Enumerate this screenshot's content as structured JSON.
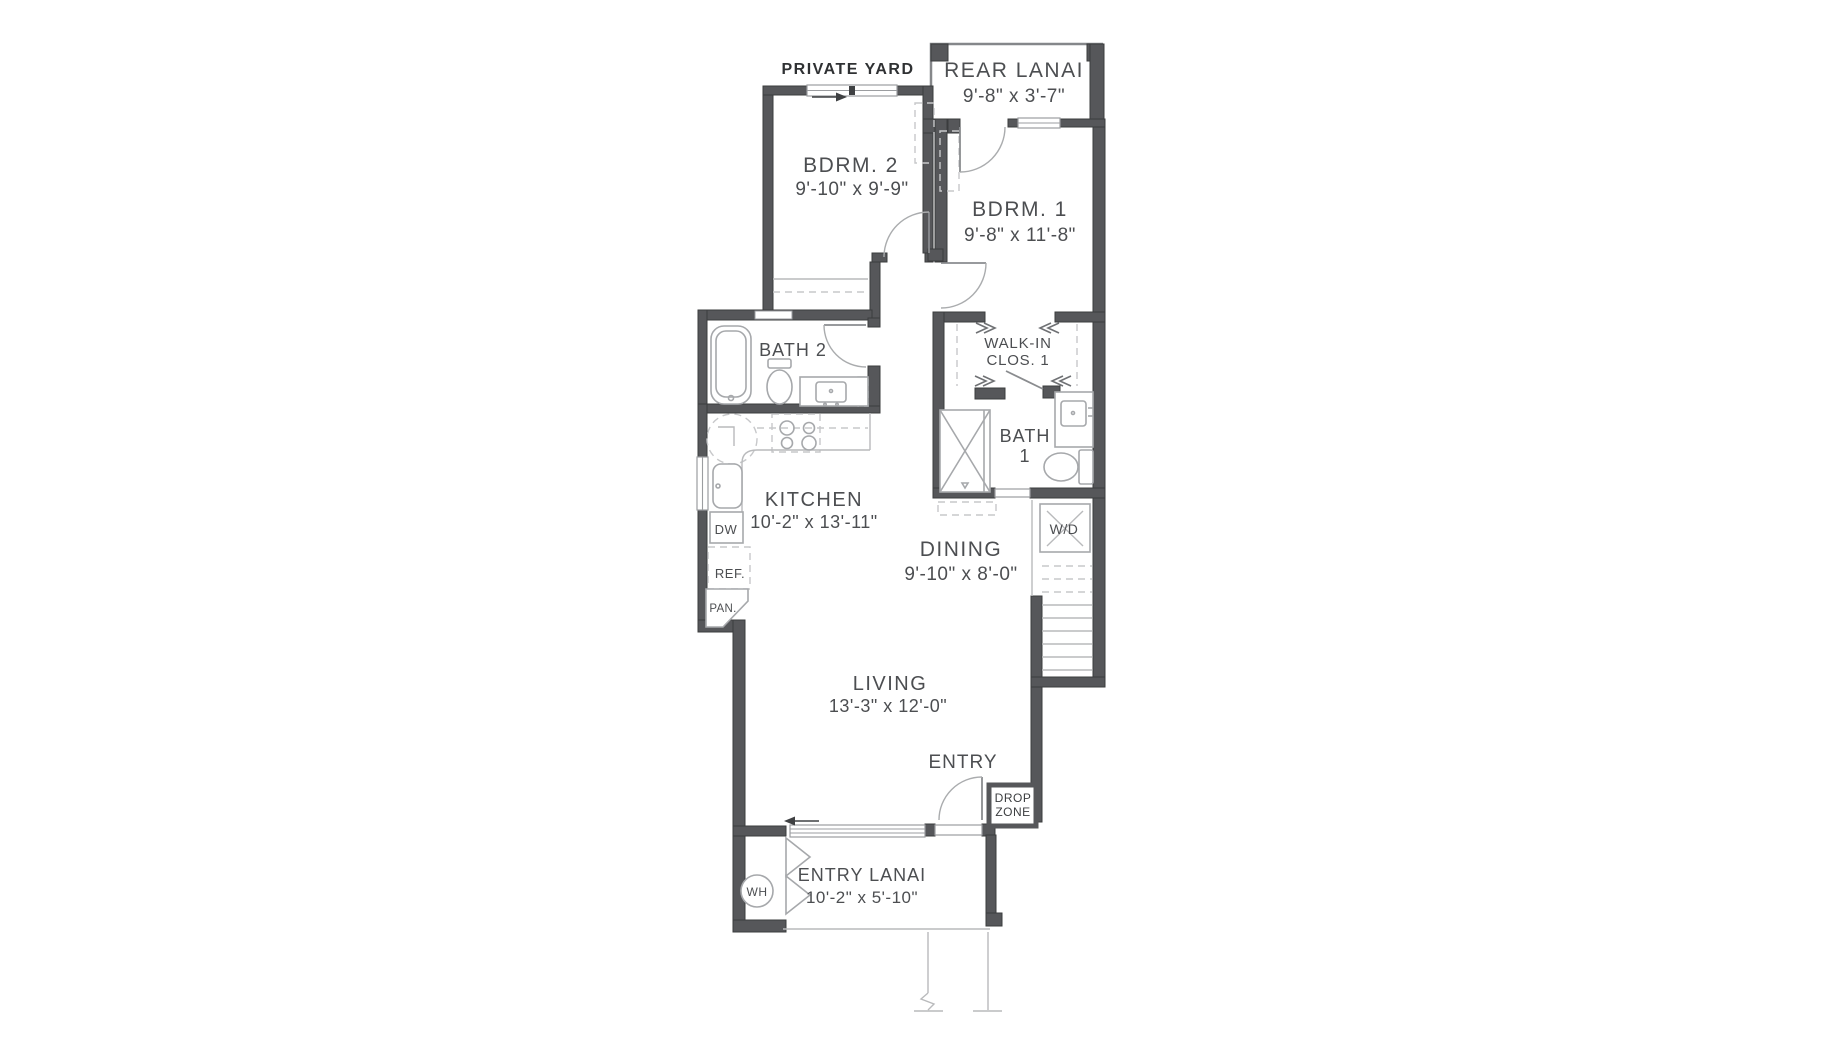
{
  "plan": {
    "yard_label": "PRIVATE YARD",
    "rooms": {
      "rear_lanai": {
        "name": "REAR LANAI",
        "dims": "9'-8\" x 3'-7\""
      },
      "bdrm2": {
        "name": "BDRM. 2",
        "dims": "9'-10\" x 9'-9\""
      },
      "bdrm1": {
        "name": "BDRM. 1",
        "dims": "9'-8\" x 11'-8\""
      },
      "bath2": {
        "name": "BATH 2"
      },
      "walkin": {
        "line1": "WALK-IN",
        "line2": "CLOS. 1"
      },
      "bath1": {
        "line1": "BATH",
        "line2": "1"
      },
      "kitchen": {
        "name": "KITCHEN",
        "dims": "10'-2\" x 13'-11\""
      },
      "dining": {
        "name": "DINING",
        "dims": "9'-10\" x 8'-0\""
      },
      "living": {
        "name": "LIVING",
        "dims": "13'-3\" x 12'-0\""
      },
      "entry": {
        "name": "ENTRY"
      },
      "entry_lanai": {
        "name": "ENTRY LANAI",
        "dims": "10'-2\" x 5'-10\""
      },
      "drop_zone": {
        "line1": "DROP",
        "line2": "ZONE"
      }
    },
    "appliances": {
      "dw": "DW",
      "ref": "REF.",
      "pan": "PAN.",
      "wd": "W/D",
      "wh": "WH"
    },
    "colors": {
      "wall": "#56575a",
      "fixture": "#a6a8ab",
      "text": "#4c4e51"
    }
  }
}
